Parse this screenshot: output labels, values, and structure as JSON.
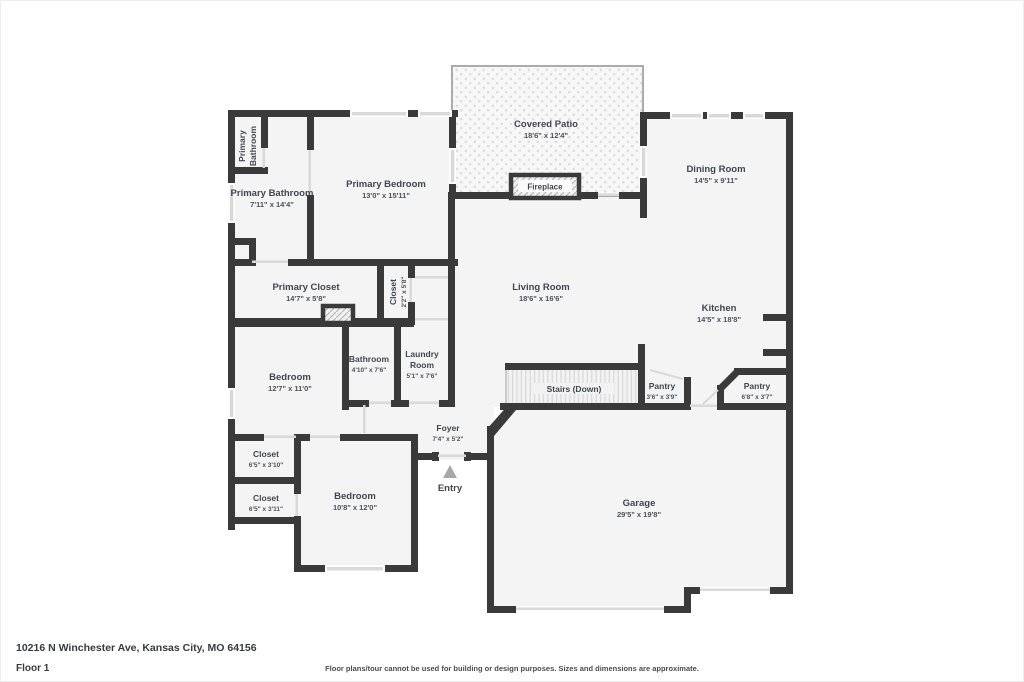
{
  "footer": {
    "address": "10216 N Winchester Ave, Kansas City, MO 64156",
    "floor_label": "Floor 1",
    "disclaimer": "Floor plans/tour cannot be used for building or design purposes. Sizes and dimensions are approximate."
  },
  "rooms": {
    "primary_bathroom_wc": {
      "line1": "Primary",
      "line2": "Bathroom"
    },
    "primary_bathroom": {
      "name": "Primary Bathroom",
      "dims": "7'11\" x 14'4\""
    },
    "primary_bedroom": {
      "name": "Primary Bedroom",
      "dims": "13'0\" x 15'11\""
    },
    "covered_patio": {
      "name": "Covered Patio",
      "dims": "18'6\" x 12'4\""
    },
    "dining_room": {
      "name": "Dining Room",
      "dims": "14'5\" x 9'11\""
    },
    "primary_closet": {
      "name": "Primary Closet",
      "dims": "14'7\" x 5'8\""
    },
    "closet_hall": {
      "name": "Closet",
      "dims": "2'2\" x 5'8\""
    },
    "living_room": {
      "name": "Living Room",
      "dims": "18'6\" x 16'6\""
    },
    "kitchen": {
      "name": "Kitchen",
      "dims": "14'5\" x 18'8\""
    },
    "bedroom_left": {
      "name": "Bedroom",
      "dims": "12'7\" x 11'0\""
    },
    "bathroom": {
      "name": "Bathroom",
      "dims": "4'10\" x 7'6\""
    },
    "laundry_room": {
      "line1": "Laundry",
      "line2": "Room",
      "dims": "5'1\" x 7'6\""
    },
    "stairs": {
      "name": "Stairs (Down)"
    },
    "pantry_small": {
      "name": "Pantry",
      "dims": "3'6\" x 3'9\""
    },
    "pantry_large": {
      "name": "Pantry",
      "dims": "6'8\" x 3'7\""
    },
    "foyer": {
      "name": "Foyer",
      "dims": "7'4\" x 5'2\""
    },
    "closet_upper": {
      "name": "Closet",
      "dims": "6'5\" x 3'10\""
    },
    "closet_lower": {
      "name": "Closet",
      "dims": "6'5\" x 3'11\""
    },
    "bedroom_lower": {
      "name": "Bedroom",
      "dims": "10'8\" x 12'0\""
    },
    "garage": {
      "name": "Garage",
      "dims": "29'5\" x 19'8\""
    },
    "entry": {
      "name": "Entry"
    },
    "fireplace": {
      "name": "Fireplace"
    }
  },
  "colors": {
    "wall": "#3a3a3a",
    "room_fill": "#f4f4f4",
    "window": "#d9d9d9",
    "label_text": "#3e4651",
    "entry_arrow": "#a8a8a8"
  }
}
